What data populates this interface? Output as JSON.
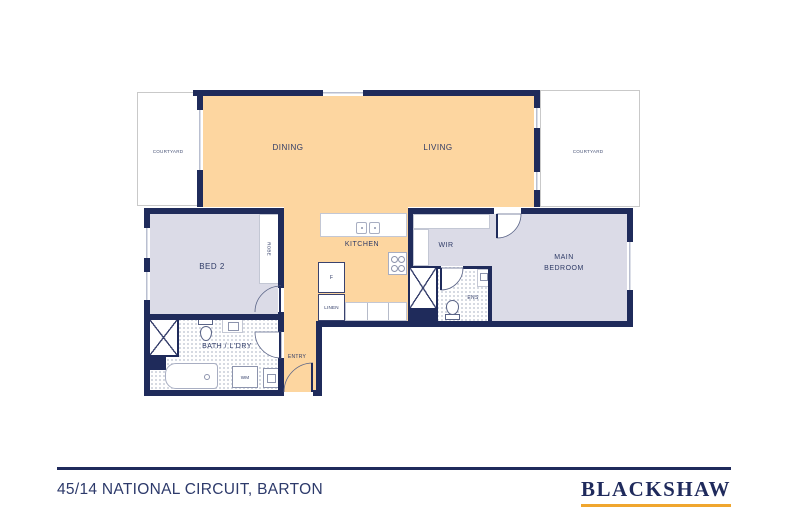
{
  "floorplan": {
    "labels": {
      "dining": "DINING",
      "living": "LIVING",
      "courtyard_left": "COURTYARD",
      "courtyard_right": "COURTYARD",
      "bed2": "BED 2",
      "robe": "ROBE",
      "kitchen": "KITCHEN",
      "fridge": "F",
      "linen": "LINEN",
      "wir": "WIR",
      "main_bedroom": "MAIN BEDROOM",
      "ens": "ENS",
      "bath_laundry": "BATH / L'DRY",
      "washing_machine": "WM",
      "entry": "ENTRY"
    },
    "colors": {
      "living_floor": "#fdd6a0",
      "bedroom_floor": "#dbdbe7",
      "wall": "#1f2b5b",
      "window": "#b9bfd0",
      "label_text": "#2e3a66"
    }
  },
  "footer": {
    "address": "45/14 NATIONAL CIRCUIT, BARTON",
    "brand": "BLACKSHAW",
    "accent_color": "#f0a62e",
    "line_color": "#1f2a5c"
  }
}
